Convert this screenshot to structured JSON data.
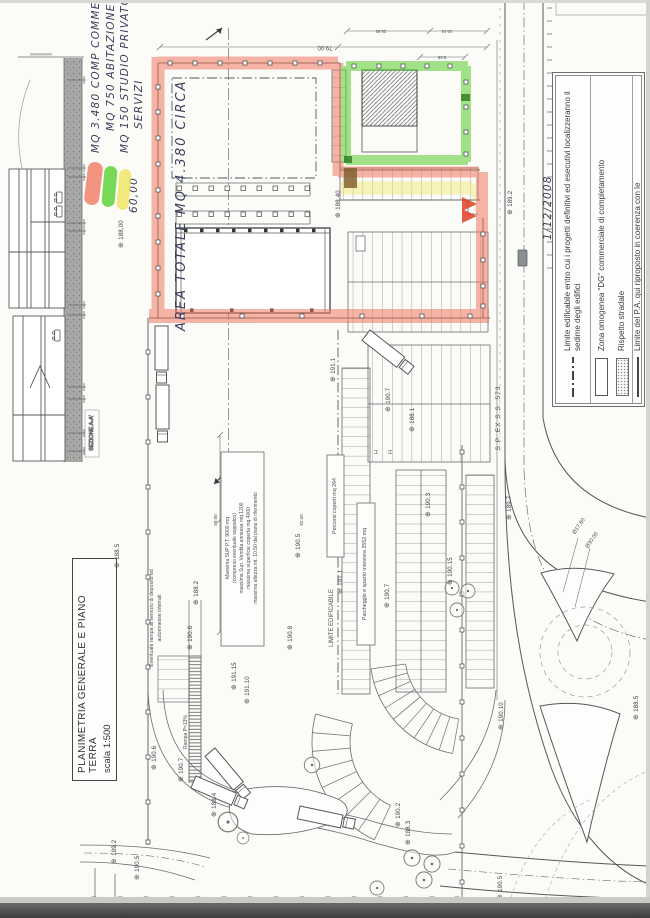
{
  "document": {
    "title": "PLANIMETRIA GENERALE E PIANO TERRA",
    "scale_note": "scala 1:500",
    "section_label": "SEZIONE A-A'"
  },
  "handwriting": {
    "line1": "MQ 3.480 COMP COMMERCIALE",
    "line2": "MQ 750 ABITAZIONE",
    "line3": "MQ 150 STUDIO PRIVATO O",
    "line4": "SERVIZI",
    "dim_width": "60,00",
    "area_total": "AREA TOTALE MQ 4.380 CIRCA",
    "date": "1/12/2008"
  },
  "legend": {
    "items": [
      {
        "symbol": "dash-dot-line",
        "label": "Limite edificabile entro cui i progetti definitivi ed esecutivi localizzeranno il sedime degli edifici"
      },
      {
        "symbol": "outline-rect",
        "label": "Zona omogenea \"DG\" commerciale di completamento"
      },
      {
        "symbol": "dotted-rect",
        "label": "Rispetto stradale"
      },
      {
        "symbol": "solid-line",
        "label": "Limite del P.A. qui riproposto in coerenza con le"
      }
    ]
  },
  "plan": {
    "notes": {
      "massima_1": "Massima SUP P.T. 9000 mq",
      "massima_2": "(compreso eventuale soppalco)",
      "massima_3": "massima Sup. Vendita annessa mq 1200",
      "massima_4": "massima superficie coperta mq 4000",
      "massima_5": "massima altezza mt. 10,50 dal piano di riferimento",
      "limite_edificabile": "LIMITE EDIFICABILE",
      "percorsi": "Percorsi coperti mq 264",
      "parcheggio": "Parcheggio e spazio manovra 3552 mq",
      "rampa_line1": "Eventuale rampa al servizio di deposito ed",
      "rampa_line2": "autorimesse interrati",
      "rampa_slope": "Rampa P=13%",
      "handicap": "H"
    },
    "road_label": "S.P. EX S.S. 573",
    "dimensions": {
      "d79": "79.00",
      "d2650": "26.50",
      "d1910": "19.10",
      "d965": "9.65",
      "d60": "60.00",
      "d8250": "82.50",
      "dia1": "Ø17.80",
      "dia2": "Ø30.00"
    },
    "spots": [
      {
        "v": "188.5",
        "x": 113,
        "y": 568
      },
      {
        "v": "188,00",
        "x": 117,
        "y": 248
      },
      {
        "v": "188.40",
        "x": 334,
        "y": 218
      },
      {
        "v": "189.2",
        "x": 506,
        "y": 215
      },
      {
        "v": "189.7",
        "x": 505,
        "y": 520
      },
      {
        "v": "190.10",
        "x": 497,
        "y": 730
      },
      {
        "v": "188.5",
        "x": 632,
        "y": 720
      },
      {
        "v": "190.5",
        "x": 496,
        "y": 900
      },
      {
        "v": "190.5",
        "x": 294,
        "y": 558
      },
      {
        "v": "190.8",
        "x": 286,
        "y": 650
      },
      {
        "v": "191.15",
        "x": 230,
        "y": 690
      },
      {
        "v": "191.10",
        "x": 243,
        "y": 704
      },
      {
        "v": "190.6",
        "x": 186,
        "y": 650
      },
      {
        "v": "190.6",
        "x": 150,
        "y": 770
      },
      {
        "v": "190.7",
        "x": 177,
        "y": 782
      },
      {
        "v": "188.2",
        "x": 192,
        "y": 605
      },
      {
        "v": "191.1",
        "x": 329,
        "y": 382
      },
      {
        "v": "191.1",
        "x": 336,
        "y": 594
      },
      {
        "v": "190.7",
        "x": 384,
        "y": 412
      },
      {
        "v": "188.1",
        "x": 408,
        "y": 432
      },
      {
        "v": "190.3",
        "x": 424,
        "y": 517
      },
      {
        "v": "190.15",
        "x": 446,
        "y": 585
      },
      {
        "v": "190.7",
        "x": 383,
        "y": 608
      },
      {
        "v": "188.4",
        "x": 210,
        "y": 817
      },
      {
        "v": "190.5",
        "x": 133,
        "y": 880
      },
      {
        "v": "189.2",
        "x": 110,
        "y": 864
      },
      {
        "v": "190.2",
        "x": 394,
        "y": 827
      },
      {
        "v": "188.3",
        "x": 404,
        "y": 845
      }
    ]
  },
  "colors": {
    "red": "#f07a60",
    "green": "#58cf2e",
    "yellow": "#f0e55e",
    "ink": "#3b3f5c"
  }
}
